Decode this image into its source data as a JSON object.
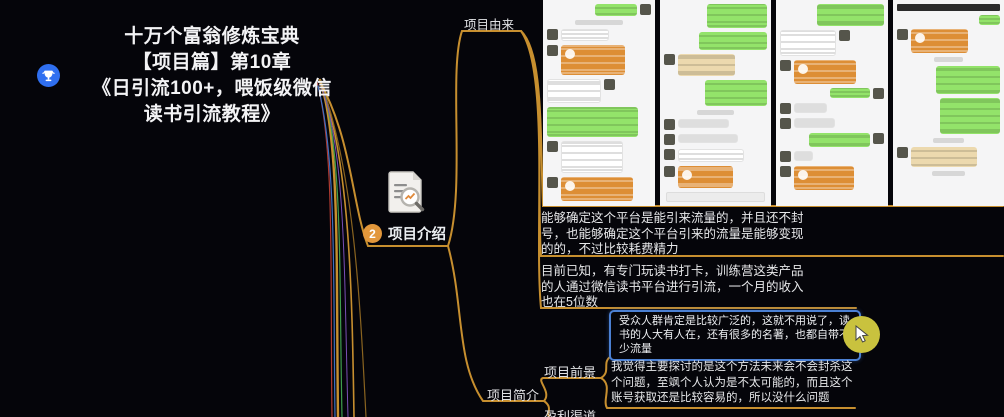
{
  "root": {
    "title_lines": [
      "十万个富翁修炼宝典",
      "【项目篇】第10章",
      "《日引流100+，喂饭级微信",
      "读书引流教程》"
    ]
  },
  "nodes": {
    "intro": {
      "badge": "2",
      "label": "项目介绍"
    },
    "origin": {
      "label": "项目由来"
    },
    "brief": {
      "label": "项目简介"
    },
    "prospect": {
      "label": "项目前景"
    },
    "profit": {
      "label": "盈利渠道"
    },
    "origin_para1": "能够确定这个平台是能引来流量的，并且还不封号，也能够确定这个平台引来的流量是能够变现的的，不过比较耗费精力",
    "origin_para2": "目前已知，有专门玩读书打卡，训练营这类产品的人通过微信读书平台进行引流，一个月的收入也在5位数",
    "selected_topic": "受众人群肯定是比较广泛的，这就不用说了，读书的人大有人在，还有很多的名著，也都自带不少流量",
    "prospect_text": "我觉得主要探讨的是这个方法未来会不会封杀这个问题，至飒个人认为是不太可能的，而且这个账号获取还是比较容易的，所以没什么问题"
  },
  "colors": {
    "branch_gold": "#c78f2f",
    "selection_blue": "#4b80d3",
    "badge_orange": "#e2973b",
    "root_icon_blue": "#2f6ff0",
    "cursor_yellow": "#c9c23e",
    "wechat_green": "#93e36a",
    "wechat_orange": "#dd8e35"
  },
  "screenshot_collage": {
    "columns": [
      [
        [
          "r",
          "green",
          40,
          12,
          "r"
        ],
        [
          "c",
          "time",
          46,
          5,
          ""
        ],
        [
          "l",
          "white",
          46,
          12,
          "l"
        ],
        [
          "l",
          "orange",
          62,
          30,
          "l"
        ],
        [
          "l",
          "white",
          52,
          24,
          "r"
        ],
        [
          "l",
          "green",
          88,
          30,
          ""
        ],
        [
          "l",
          "white",
          60,
          32,
          "l"
        ],
        [
          "l",
          "orange",
          70,
          24,
          "l"
        ]
      ],
      [
        [
          "r",
          "green",
          58,
          24,
          ""
        ],
        [
          "r",
          "green",
          66,
          18,
          ""
        ],
        [
          "l",
          "tan",
          56,
          22,
          "l"
        ],
        [
          "r",
          "green",
          60,
          26,
          ""
        ],
        [
          "c",
          "time",
          36,
          5,
          ""
        ],
        [
          "l",
          "white",
          50,
          9,
          "l"
        ],
        [
          "l",
          "white",
          58,
          9,
          "l"
        ],
        [
          "l",
          "white",
          64,
          13,
          "l"
        ],
        [
          "l",
          "orange",
          54,
          22,
          "l"
        ],
        [
          "c",
          "input",
          94,
          8,
          ""
        ]
      ],
      [
        [
          "r",
          "green",
          64,
          22,
          ""
        ],
        [
          "l",
          "white",
          54,
          26,
          "r"
        ],
        [
          "l",
          "orange",
          60,
          24,
          "l"
        ],
        [
          "r",
          "green",
          38,
          10,
          "r"
        ],
        [
          "l",
          "white",
          32,
          10,
          "l"
        ],
        [
          "l",
          "white",
          40,
          10,
          "l"
        ],
        [
          "r",
          "green",
          58,
          14,
          "r"
        ],
        [
          "l",
          "white",
          18,
          10,
          "l"
        ],
        [
          "l",
          "orange",
          58,
          24,
          "l"
        ]
      ],
      [
        [
          "c",
          "dark",
          100,
          7,
          ""
        ],
        [
          "r",
          "green",
          20,
          10,
          ""
        ],
        [
          "l",
          "orange",
          56,
          24,
          "l"
        ],
        [
          "c",
          "time",
          28,
          5,
          ""
        ],
        [
          "r",
          "green",
          62,
          28,
          ""
        ],
        [
          "r",
          "green",
          58,
          36,
          ""
        ],
        [
          "c",
          "time",
          30,
          5,
          ""
        ],
        [
          "l",
          "tan",
          64,
          20,
          "l"
        ],
        [
          "c",
          "time",
          32,
          5,
          ""
        ]
      ]
    ]
  }
}
